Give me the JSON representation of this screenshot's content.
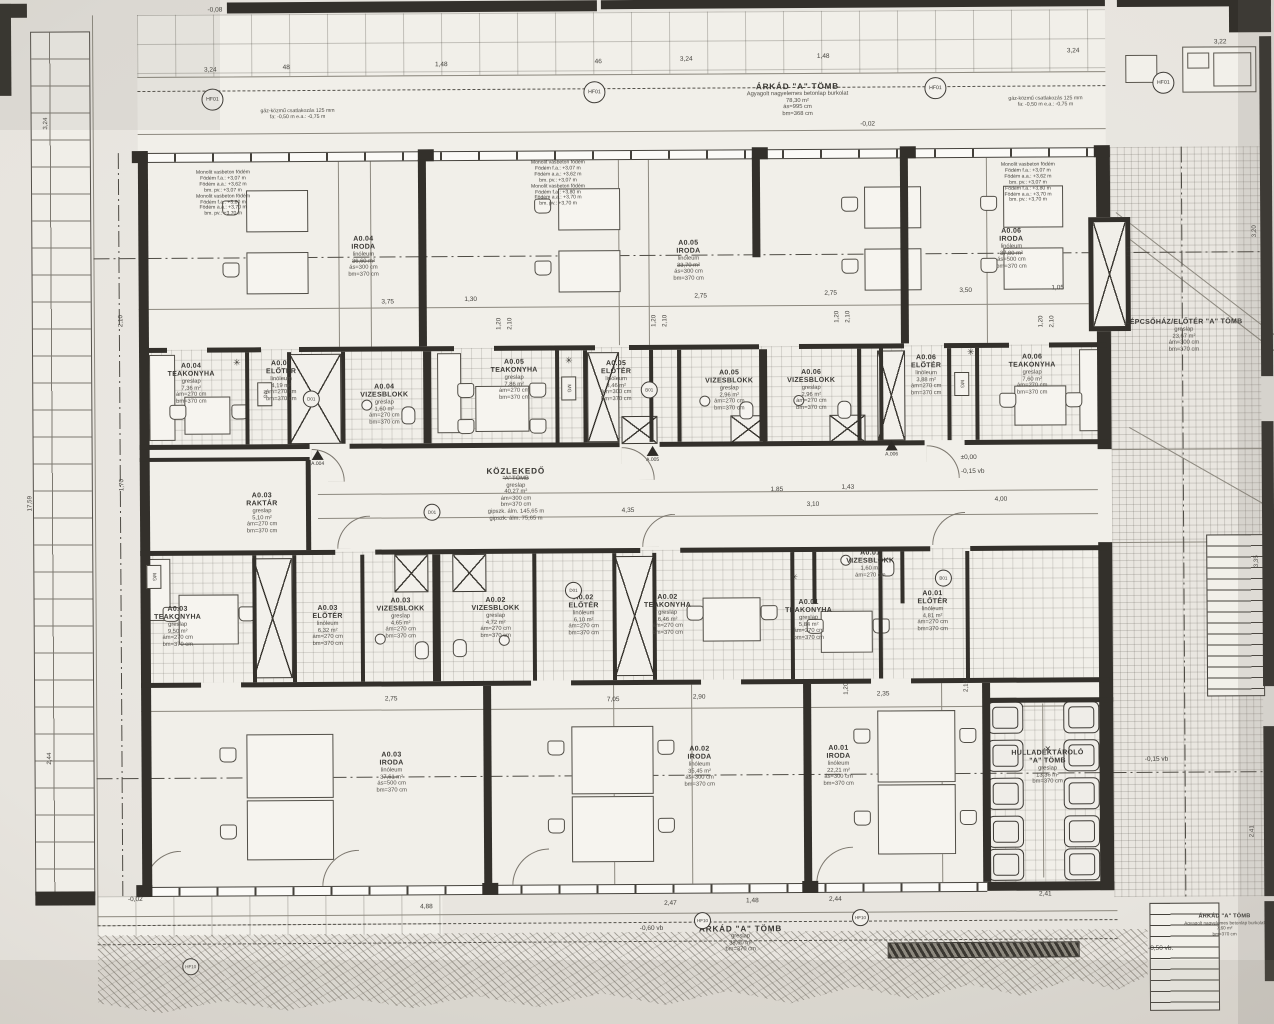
{
  "rooms": {
    "a004i": {
      "code": "A0.04",
      "name": "IRODA",
      "finish": "linóleum",
      "area": "36,60 m²",
      "h1": "ás=300 cm",
      "h2": "bm=370 cm"
    },
    "a005i": {
      "code": "A0.05",
      "name": "IRODA",
      "finish": "linóleum",
      "area": "33,70 m²",
      "h1": "ás=300 cm",
      "h2": "bm=370 cm"
    },
    "a006i": {
      "code": "A0.06",
      "name": "IRODA",
      "finish": "linóleum",
      "area": "37,80 m²",
      "h1": "ás=500 cm",
      "h2": "bm=370 cm"
    },
    "a004t": {
      "code": "A0.04",
      "name": "TEAKONYHA",
      "finish": "greslap",
      "area": "7,36 m²",
      "h1": "ám=270 cm",
      "h2": "bm=370 cm"
    },
    "a004e": {
      "code": "A0.04",
      "name": "ELŐTÉR",
      "finish": "linóleum",
      "area": "4,19 m²",
      "h1": "ám=270 cm",
      "h2": "bm=370 cm"
    },
    "a004v": {
      "code": "A0.04",
      "name": "VIZESBLOKK",
      "finish": "greslap",
      "area": "1,60 m²",
      "h1": "ám=270 cm",
      "h2": "bm=370 cm"
    },
    "a005t": {
      "code": "A0.05",
      "name": "TEAKONYHA",
      "finish": "greslap",
      "area": "7,86 m²",
      "h1": "ám=270 cm",
      "h2": "bm=370 cm"
    },
    "a005e": {
      "code": "A0.05",
      "name": "ELŐTÉR",
      "finish": "linóleum",
      "area": "3,46 m²",
      "h1": "ám=300 cm",
      "h2": "bm=370 cm"
    },
    "a005v": {
      "code": "A0.05",
      "name": "VIZESBLOKK",
      "finish": "greslap",
      "area": "2,96 m²",
      "h1": "ám=270 cm",
      "h2": "bm=370 cm"
    },
    "a006v": {
      "code": "A0.06",
      "name": "VIZESBLOKK",
      "finish": "greslap",
      "area": "2,96 m²",
      "h1": "ám=270 cm",
      "h2": "bm=370 cm"
    },
    "a006e": {
      "code": "A0.06",
      "name": "ELŐTÉR",
      "finish": "linóleum",
      "area": "3,88 m²",
      "h1": "ám=270 cm",
      "h2": "bm=370 cm"
    },
    "a006t": {
      "code": "A0.06",
      "name": "TEAKONYHA",
      "finish": "greslap",
      "area": "7,60 m²",
      "h1": "ám=270 cm",
      "h2": "bm=370 cm"
    },
    "a003r": {
      "code": "A0.03",
      "name": "RAKTÁR",
      "finish": "greslap",
      "area": "5,10 m²",
      "h1": "ám=270 cm",
      "h2": "bm=370 cm"
    },
    "kozl": {
      "name": "KÖZLEKEDŐ",
      "name2": "\"A\" TÖMB",
      "finish": "greslap",
      "area": "40,27 m²",
      "h1": "ám=300 cm",
      "h2": "bm=370 cm",
      "note1": "gipszk. álm. 145,65 m",
      "note2": "gipszk. álm. 75,65 m"
    },
    "a003t": {
      "code": "A0.03",
      "name": "TEAKONYHA",
      "finish": "greslap",
      "area": "9,50 m²",
      "h1": "ám=270 cm",
      "h2": "bm=370 cm"
    },
    "a003e": {
      "code": "A0.03",
      "name": "ELŐTÉR",
      "finish": "linóleum",
      "area": "6,32 m²",
      "h1": "ám=270 cm",
      "h2": "bm=370 cm"
    },
    "a003v": {
      "code": "A0.03",
      "name": "VIZESBLOKK",
      "finish": "greslap",
      "area": "4,65 m²",
      "h1": "ám=270 cm",
      "h2": "bm=370 cm"
    },
    "a002v": {
      "code": "A0.02",
      "name": "VIZESBLOKK",
      "finish": "greslap",
      "area": "4,72 m²",
      "h1": "ám=270 cm",
      "h2": "bm=370 cm"
    },
    "a002e": {
      "code": "A0.02",
      "name": "ELŐTÉR",
      "finish": "linóleum",
      "area": "6,10 m²",
      "h1": "ám=270 cm",
      "h2": "bm=370 cm"
    },
    "a002t": {
      "code": "A0.02",
      "name": "TEAKONYHA",
      "finish": "greslap",
      "area": "6,46 m²",
      "h1": "ám=270 cm",
      "h2": "bm=370 cm"
    },
    "a001v": {
      "code": "A0.01",
      "name": "VIZESBLOKK",
      "finish": "greslap",
      "area": "1,60 m²",
      "h1": "ám=270 cm"
    },
    "a001t": {
      "code": "A0.01",
      "name": "TEAKONYHA",
      "finish": "greslap",
      "area": "5,84 m²",
      "h1": "ám=270 cm",
      "h2": "bm=370 cm"
    },
    "a001e": {
      "code": "A0.01",
      "name": "ELŐTÉR",
      "finish": "linóleum",
      "area": "4,81 m²",
      "h1": "ám=270 cm",
      "h2": "bm=370 cm"
    },
    "a003i": {
      "code": "A0.03",
      "name": "IRODA",
      "finish": "linóleum",
      "area": "37,61 m²",
      "h1": "ás=500 cm",
      "h2": "bm=370 cm"
    },
    "a002i": {
      "code": "A0.02",
      "name": "IRODA",
      "finish": "linóleum",
      "area": "35,45 m²",
      "h1": "ás=300 cm",
      "h2": "bm=370 cm"
    },
    "a001i": {
      "code": "A0.01",
      "name": "IRODA",
      "finish": "linóleum",
      "area": "22,21 m²",
      "h1": "ás=300 cm",
      "h2": "bm=370 cm"
    },
    "lepcso": {
      "name": "LÉPCSŐHÁZ/ELŐTÉR \"A\" TÖMB",
      "finish": "greslap",
      "area": "23,67 m²",
      "h1": "ám=300 cm",
      "h2": "bm=370 cm"
    },
    "hull": {
      "name": "HULLADÉKTÁROLÓ",
      "name2": "\"A\" TÖMB",
      "finish": "greslap",
      "area": "13,36 m²",
      "h2": "bm=370 cm"
    },
    "arkt": {
      "name": "ÁRKÁD \"A\" TÖMB",
      "finish": "Agyagolt nagyelemes betonlap burkolat",
      "area": "78,30 m²",
      "h1": "ás=995 cm",
      "h2": "bm=368 cm"
    },
    "arkb": {
      "name": "ÁRKÁD \"A\" TÖMB",
      "finish": "greslap",
      "area": "38,60 m²",
      "h2": "bm=370 cm"
    },
    "arkr": {
      "name": "ÁRKÁD \"A\" TÖMB",
      "finish": "Agyagolt nagyelemes betonlap burkolat",
      "area": "7,60 m²",
      "h2": "bm=370 cm"
    }
  },
  "slab": {
    "l1": "Monolit vasbeton födém",
    "l2": "Födém f.a.: +3,07 m",
    "l3": "Födém a.a.: +3,62 m",
    "l4": "bm. pv.: +3,07 m",
    "l5": "Monolit vasbeton födém",
    "l6": "Födém f.a.: +3,80 m",
    "l7": "Födém a.a.: +3,70 m",
    "l8": "bm. pv.: +3,70 m"
  },
  "gas": {
    "l1": "gáz-közmű csatlakozás 125 mm",
    "l2": "fa: -0,50 m   e.a.: -0,75 m"
  },
  "levels": {
    "lv1": "-0,02",
    "lv2": "-0,02",
    "lv3": "±0,00",
    "lv4": "-0,15 vb",
    "lv5": "-0,15 vb",
    "lv6": "-0,60 vb",
    "lv7": "-0,50 vb.",
    "lv8": "-0,08"
  },
  "marks": {
    "hf01": "HF01",
    "hf10": "HF10",
    "d01": "D01",
    "b01": "B01",
    "mg": "MG",
    "lift": "LIFT",
    "star": "✳",
    "s4": "A.004",
    "s5": "A.005",
    "s6": "A.006",
    "cross": "✕"
  },
  "dims": {
    "t1": "3,24",
    "t2": "48",
    "t3": "1,48",
    "t4": "46",
    "t5": "3,24",
    "t6": "1,48",
    "t7": "3,24",
    "t8": "3,22",
    "m1": "3,75",
    "m2": "1,30",
    "m3": "2,75",
    "m4": "2,75",
    "m5": "3,50",
    "m6": "1,05",
    "v1": "1,20",
    "v2": "2,10",
    "c1": "4,35",
    "c2": "3,10",
    "c3": "4,00",
    "c4": "1,43",
    "c5": "1,85",
    "d1": "2,75",
    "d2": "7,05",
    "d3": "2,90",
    "d4": "2,35",
    "g1": "4,88",
    "g2": "2,47",
    "g3": "1,48",
    "g4": "2,44",
    "g5": "2,41",
    "L1": "3,24",
    "L2": "17,59",
    "L3": "2,44",
    "R1": "3,20",
    "R2": "3,35",
    "R3": "2,41",
    "i1": "2,10",
    "i2": "1,70"
  }
}
